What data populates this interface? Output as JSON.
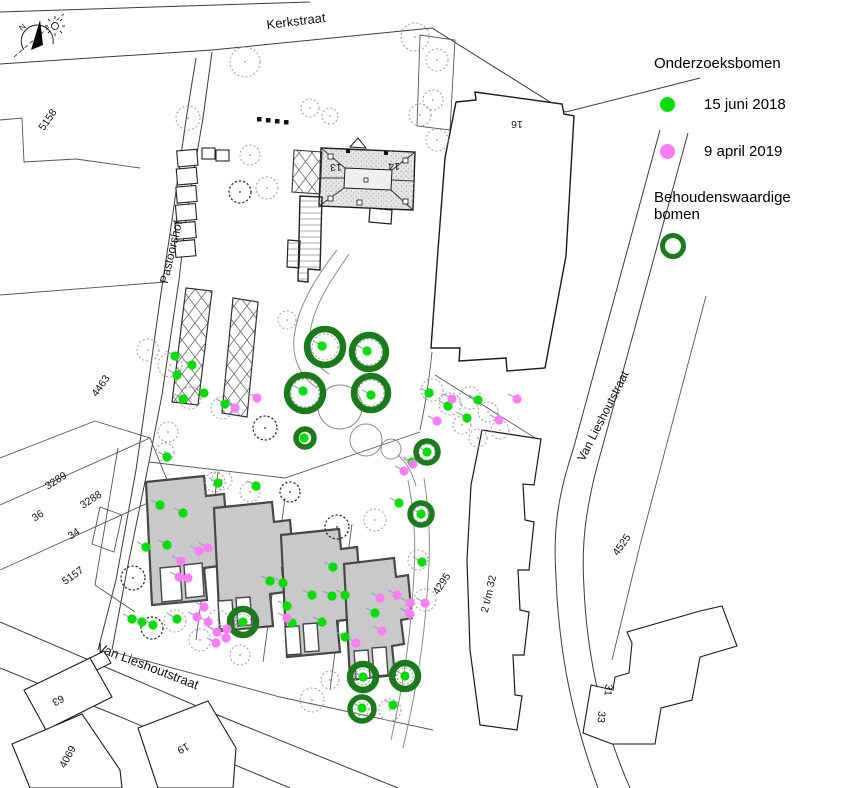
{
  "legend": {
    "title": "Onderzoeksbomen",
    "items": [
      {
        "id": "survey-2018",
        "label": "15 juni 2018",
        "color": "#00db00"
      },
      {
        "id": "survey-2019",
        "label": "9 april 2019",
        "color": "#ff7df7"
      }
    ],
    "preserve": {
      "label": "Behoudenswaardige bomen",
      "color": "#1a7a1c"
    }
  },
  "compass": {
    "north_label": "N"
  },
  "streets": [
    {
      "name": "Kerkstraat",
      "x": 296,
      "y": 21,
      "rot": -7,
      "size": 13
    },
    {
      "name": "Pastoorshof",
      "x": 171,
      "y": 252,
      "rot": -77,
      "size": 12
    },
    {
      "name": "Van Lieshoutstraat",
      "x": 603,
      "y": 416,
      "rot": -63,
      "size": 12
    },
    {
      "name": "Van Lieshoutstraat",
      "x": 148,
      "y": 666,
      "rot": 21,
      "size": 13
    }
  ],
  "parcels": [
    {
      "name": "5158",
      "x": 48,
      "y": 120,
      "rot": -55
    },
    {
      "name": "4463",
      "x": 101,
      "y": 386,
      "rot": -55
    },
    {
      "name": "3289",
      "x": 56,
      "y": 481,
      "rot": -33
    },
    {
      "name": "3288",
      "x": 91,
      "y": 500,
      "rot": -33
    },
    {
      "name": "36",
      "x": 38,
      "y": 516,
      "rot": -33
    },
    {
      "name": "34",
      "x": 74,
      "y": 534,
      "rot": -33
    },
    {
      "name": "5157",
      "x": 73,
      "y": 576,
      "rot": -35
    },
    {
      "name": "4295",
      "x": 442,
      "y": 584,
      "rot": -57
    },
    {
      "name": "4525",
      "x": 622,
      "y": 545,
      "rot": -55
    },
    {
      "name": "2 t/m 32",
      "x": 489,
      "y": 594,
      "rot": -77
    },
    {
      "name": "16",
      "x": 517,
      "y": 124,
      "rot": 180
    },
    {
      "name": "13",
      "x": 336,
      "y": 167,
      "rot": 180
    },
    {
      "name": "14",
      "x": 394,
      "y": 166,
      "rot": 180
    },
    {
      "name": "63",
      "x": 58,
      "y": 700,
      "rot": 152
    },
    {
      "name": "4069",
      "x": 68,
      "y": 757,
      "rot": -62
    },
    {
      "name": "19",
      "x": 183,
      "y": 748,
      "rot": 152
    },
    {
      "name": "31",
      "x": 608,
      "y": 690,
      "rot": 95
    },
    {
      "name": "33",
      "x": 601,
      "y": 717,
      "rot": 95
    }
  ],
  "survey": {
    "dots_2018": [
      [
        322,
        346
      ],
      [
        367,
        351
      ],
      [
        303,
        391
      ],
      [
        371,
        395
      ],
      [
        304,
        438
      ],
      [
        427,
        452
      ],
      [
        421,
        514
      ],
      [
        243,
        622
      ],
      [
        363,
        677
      ],
      [
        405,
        676
      ],
      [
        362,
        708
      ],
      [
        175,
        356
      ],
      [
        192,
        365
      ],
      [
        177,
        375
      ],
      [
        183,
        399
      ],
      [
        204,
        393
      ],
      [
        225,
        404
      ],
      [
        167,
        457
      ],
      [
        218,
        483
      ],
      [
        256,
        486
      ],
      [
        429,
        393
      ],
      [
        448,
        406
      ],
      [
        478,
        400
      ],
      [
        467,
        418
      ],
      [
        412,
        462
      ],
      [
        399,
        503
      ],
      [
        422,
        562
      ],
      [
        160,
        505
      ],
      [
        183,
        513
      ],
      [
        167,
        545
      ],
      [
        146,
        547
      ],
      [
        177,
        619
      ],
      [
        142,
        622
      ],
      [
        132,
        619
      ],
      [
        153,
        625
      ],
      [
        270,
        581
      ],
      [
        283,
        583
      ],
      [
        312,
        595
      ],
      [
        287,
        606
      ],
      [
        292,
        623
      ],
      [
        322,
        622
      ],
      [
        332,
        596
      ],
      [
        375,
        613
      ],
      [
        345,
        637
      ],
      [
        393,
        705
      ],
      [
        333,
        567
      ],
      [
        345,
        595
      ]
    ],
    "dots_2019": [
      [
        235,
        408
      ],
      [
        257,
        398
      ],
      [
        452,
        399
      ],
      [
        517,
        399
      ],
      [
        499,
        420
      ],
      [
        437,
        421
      ],
      [
        404,
        471
      ],
      [
        413,
        464
      ],
      [
        425,
        603
      ],
      [
        410,
        614
      ],
      [
        208,
        548
      ],
      [
        181,
        561
      ],
      [
        179,
        577
      ],
      [
        188,
        578
      ],
      [
        199,
        551
      ],
      [
        197,
        617
      ],
      [
        204,
        607
      ],
      [
        208,
        622
      ],
      [
        217,
        632
      ],
      [
        226,
        638
      ],
      [
        227,
        629
      ],
      [
        216,
        643
      ],
      [
        287,
        618
      ],
      [
        380,
        598
      ],
      [
        397,
        595
      ],
      [
        410,
        603
      ],
      [
        409,
        613
      ],
      [
        382,
        631
      ],
      [
        356,
        643
      ]
    ],
    "preserved_rings": [
      [
        325,
        347,
        18
      ],
      [
        369,
        352,
        17
      ],
      [
        305,
        393,
        18
      ],
      [
        371,
        393,
        17
      ],
      [
        305,
        438,
        9
      ],
      [
        427,
        452,
        11
      ],
      [
        421,
        514,
        11
      ],
      [
        243,
        622,
        13
      ],
      [
        363,
        677,
        13
      ],
      [
        405,
        676,
        13
      ],
      [
        362,
        709,
        12
      ]
    ]
  },
  "trees": [
    [
      188,
      118,
      12,
      0
    ],
    [
      245,
      62,
      15,
      0
    ],
    [
      310,
      108,
      9,
      0
    ],
    [
      330,
      116,
      8,
      0
    ],
    [
      415,
      37,
      14,
      0
    ],
    [
      420,
      115,
      11,
      0
    ],
    [
      437,
      60,
      11,
      0
    ],
    [
      433,
      100,
      10,
      0
    ],
    [
      250,
      155,
      10,
      0
    ],
    [
      267,
      188,
      11,
      0
    ],
    [
      240,
      192,
      11,
      1
    ],
    [
      437,
      140,
      11,
      0
    ],
    [
      287,
      320,
      9,
      0
    ],
    [
      325,
      347,
      13,
      0
    ],
    [
      369,
      352,
      13,
      0
    ],
    [
      305,
      393,
      14,
      0
    ],
    [
      371,
      393,
      13,
      0
    ],
    [
      305,
      438,
      7,
      0
    ],
    [
      427,
      452,
      8,
      0
    ],
    [
      421,
      514,
      8,
      0
    ],
    [
      265,
      428,
      12,
      1
    ],
    [
      222,
      480,
      10,
      0
    ],
    [
      250,
      492,
      10,
      0
    ],
    [
      165,
      452,
      9,
      0
    ],
    [
      148,
      350,
      11,
      0
    ],
    [
      170,
      365,
      12,
      0
    ],
    [
      190,
      398,
      11,
      0
    ],
    [
      222,
      408,
      11,
      0
    ],
    [
      168,
      432,
      10,
      0
    ],
    [
      432,
      390,
      11,
      0
    ],
    [
      450,
      404,
      11,
      0
    ],
    [
      470,
      398,
      11,
      0
    ],
    [
      488,
      412,
      10,
      0
    ],
    [
      462,
      425,
      9,
      0
    ],
    [
      500,
      430,
      9,
      0
    ],
    [
      478,
      438,
      9,
      0
    ],
    [
      215,
      482,
      10,
      0
    ],
    [
      290,
      492,
      10,
      1
    ],
    [
      337,
      527,
      12,
      1
    ],
    [
      375,
      520,
      11,
      0
    ],
    [
      133,
      578,
      12,
      1
    ],
    [
      152,
      628,
      11,
      1
    ],
    [
      175,
      621,
      11,
      0
    ],
    [
      200,
      640,
      11,
      0
    ],
    [
      218,
      620,
      10,
      0
    ],
    [
      240,
      655,
      10,
      0
    ],
    [
      312,
      700,
      12,
      0
    ],
    [
      330,
      680,
      9,
      0
    ],
    [
      390,
      710,
      11,
      0
    ],
    [
      418,
      560,
      10,
      0
    ],
    [
      425,
      600,
      11,
      0
    ],
    [
      363,
      677,
      8,
      0
    ],
    [
      405,
      676,
      8,
      0
    ],
    [
      362,
      709,
      7,
      0
    ],
    [
      243,
      622,
      8,
      0
    ]
  ],
  "furniture_marks": [
    [
      257,
      117
    ],
    [
      266,
      118
    ],
    [
      275,
      119
    ],
    [
      284,
      120
    ]
  ]
}
